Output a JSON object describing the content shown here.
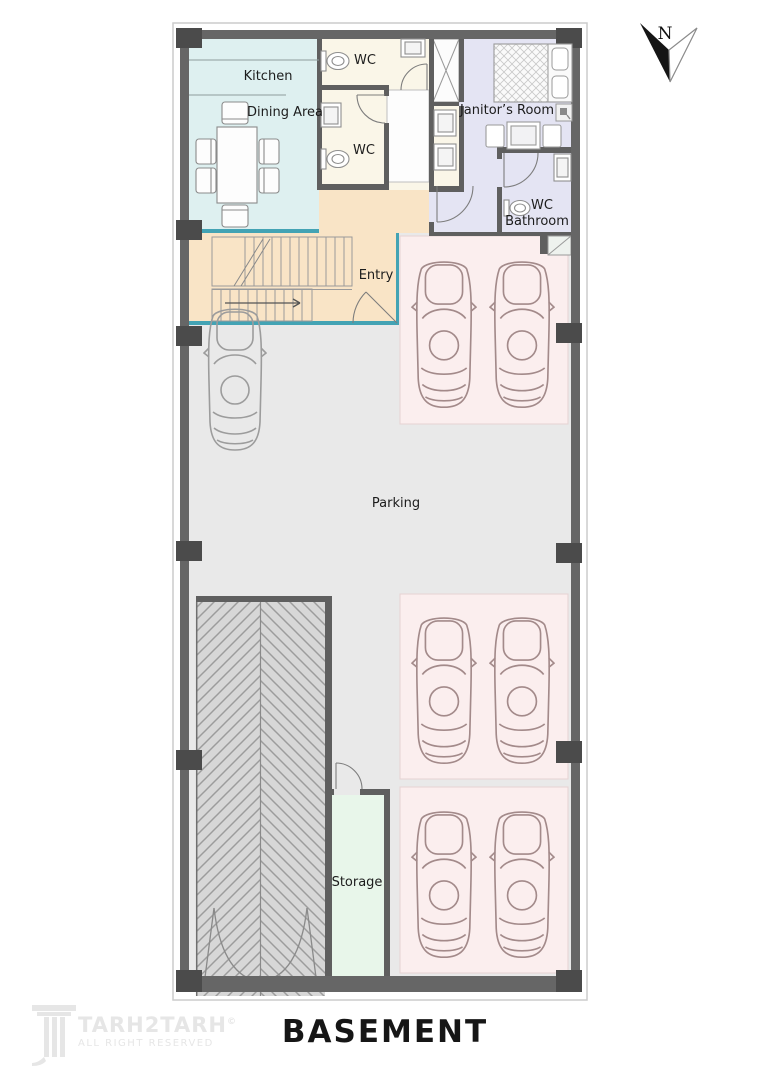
{
  "plan": {
    "title": "BASEMENT",
    "compass": {
      "label": "N"
    },
    "rooms": {
      "kitchen": {
        "label": "Kitchen"
      },
      "dining": {
        "label": "Dining Area"
      },
      "wc_top": {
        "label": "WC"
      },
      "wc_mid": {
        "label": "WC"
      },
      "janitor": {
        "label": "Janitor’s Room"
      },
      "wc_bathroom": {
        "line1": "WC",
        "line2": "Bathroom"
      },
      "entry": {
        "label": "Entry"
      },
      "parking": {
        "label": "Parking"
      },
      "storage": {
        "label": "Storage"
      }
    }
  },
  "watermark": {
    "brand": "TARH2TARH",
    "tagline": "ALL RIGHT RESERVED",
    "copyright_symbol": "©"
  },
  "colors": {
    "wall": "#666666",
    "wallDark": "#4b4b4b",
    "kitchen": "#def0f0",
    "cream": "#faf6e8",
    "lavender": "#e4e4f3",
    "peach": "#f9e4c6",
    "floor": "#e9e9e9",
    "pad": "#fbeeee",
    "padBorder": "#e6d2d2",
    "storage": "#e8f6ea",
    "ramp": "#d7d7d7",
    "rampLine": "#9c9c9c",
    "teal": "#43a3b4",
    "carPink": "#a38a8a",
    "carGray": "#9c9c9c",
    "text": "#1c1c1c",
    "watermark": "#e6e6e6"
  }
}
